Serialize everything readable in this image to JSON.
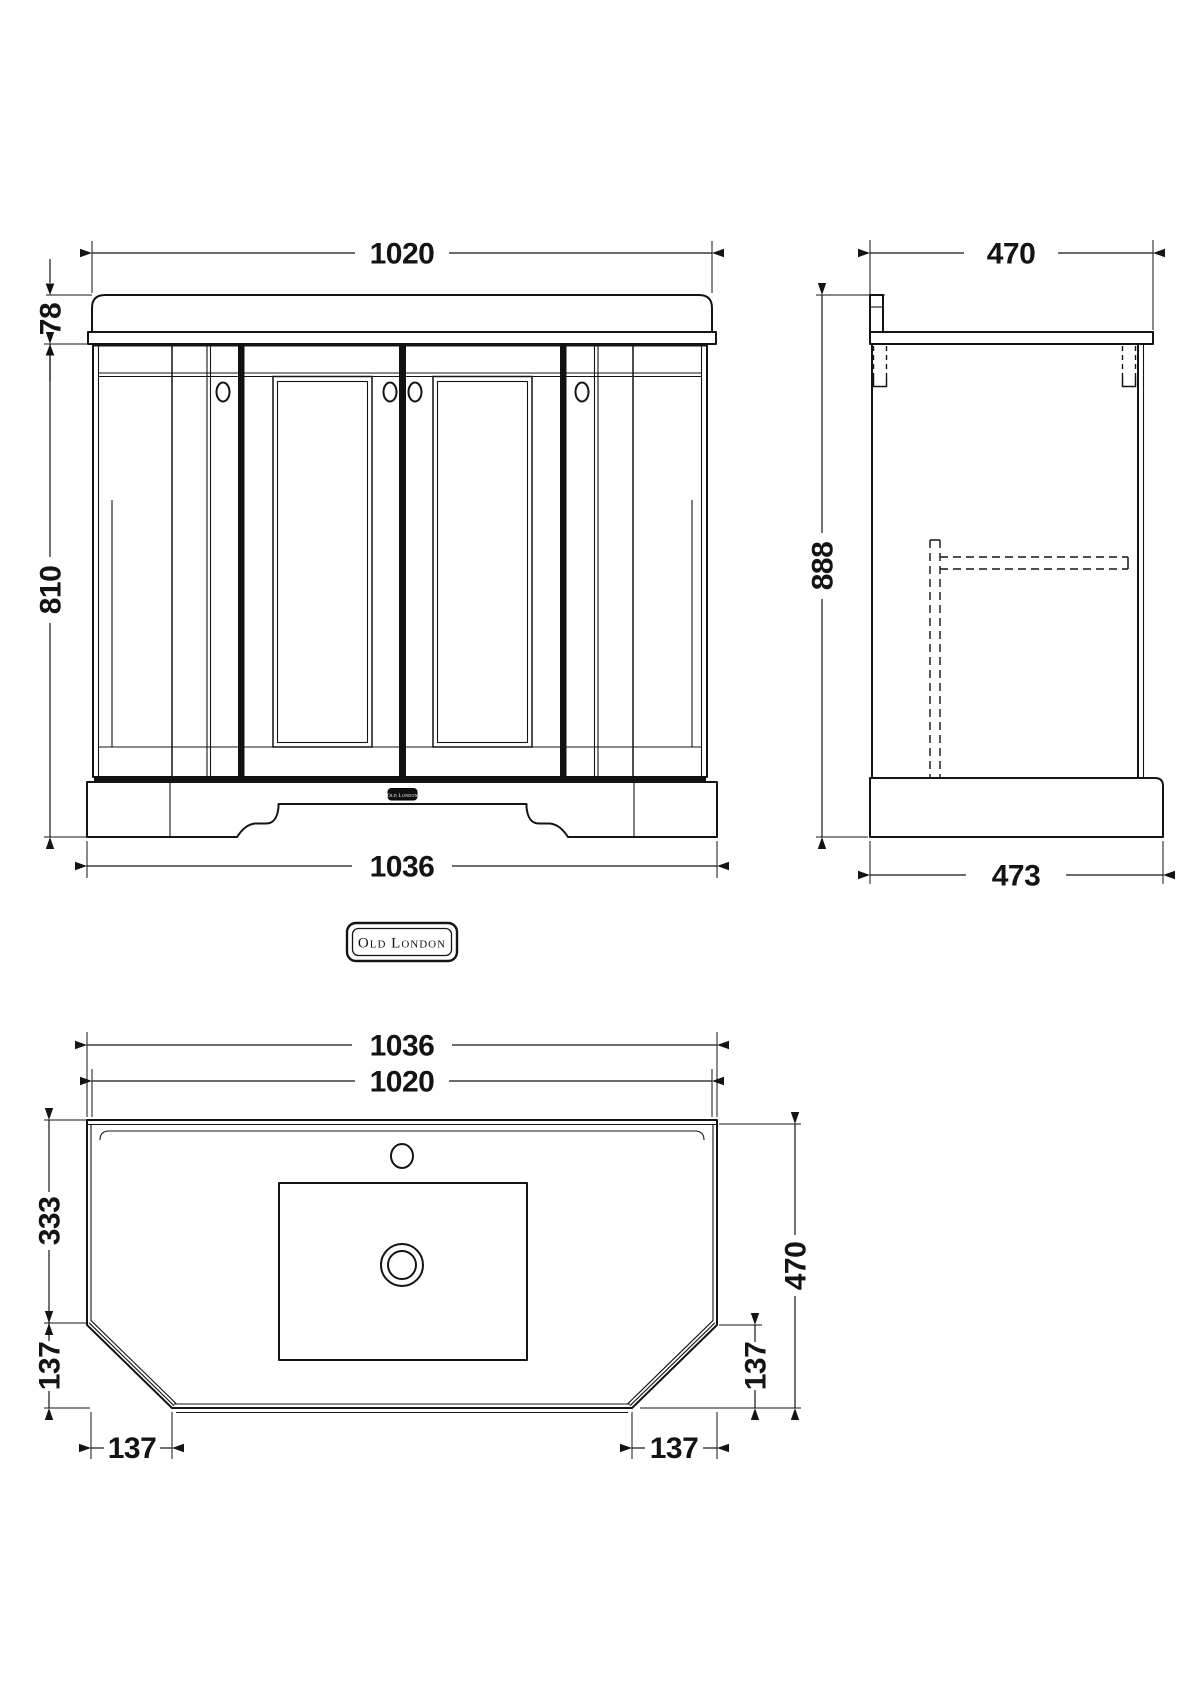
{
  "drawing": {
    "brand_badge": "Old London",
    "plinth_plate": "Old London",
    "front_view": {
      "top_width": "1020",
      "counter_height": "78",
      "cabinet_height": "810",
      "base_width": "1036"
    },
    "side_view": {
      "top_depth": "470",
      "overall_height": "888",
      "base_depth": "473"
    },
    "plan_view": {
      "outer_width": "1036",
      "inner_width": "1020",
      "back_to_chamfer": "333",
      "chamfer_height_left": "137",
      "chamfer_width_left": "137",
      "chamfer_height_right": "137",
      "chamfer_width_right": "137",
      "overall_depth": "470"
    }
  }
}
